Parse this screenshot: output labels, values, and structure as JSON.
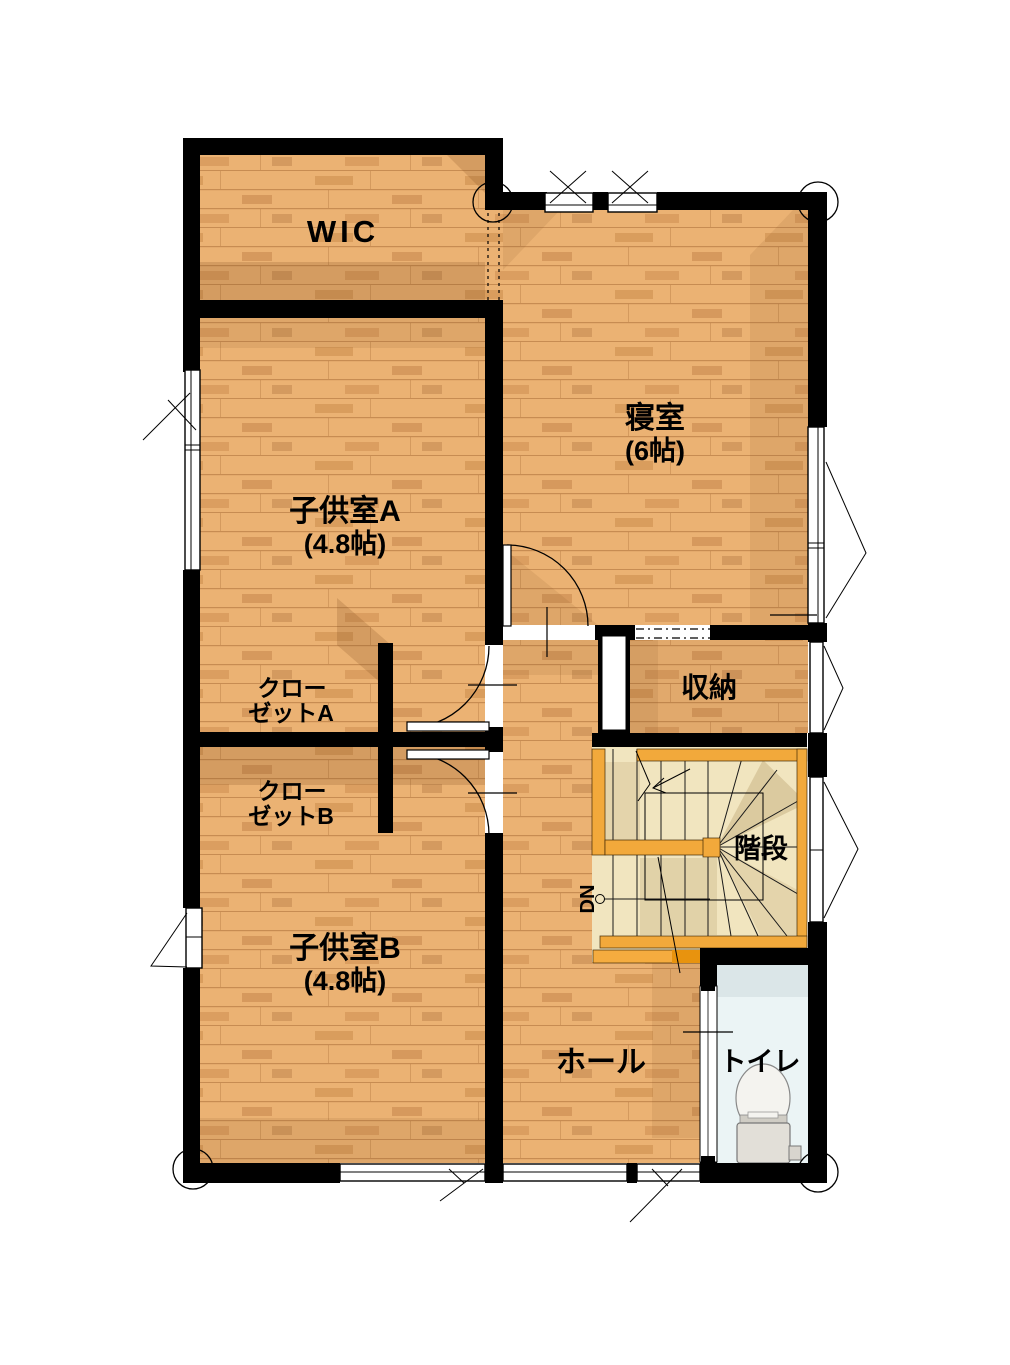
{
  "rooms": {
    "wic": {
      "label": "WIC"
    },
    "bedroom": {
      "label": "寝室",
      "size": "(6帖)"
    },
    "child_a": {
      "label": "子供室A",
      "size": "(4.8帖)"
    },
    "child_b": {
      "label": "子供室B",
      "size": "(4.8帖)"
    },
    "closet_a": {
      "line1": "クロー",
      "line2": "ゼットA"
    },
    "closet_b": {
      "line1": "クロー",
      "line2": "ゼットB"
    },
    "storage": {
      "label": "収納"
    },
    "stairs": {
      "label": "階段",
      "direction_label": "DN"
    },
    "hall": {
      "label": "ホール"
    },
    "toilet": {
      "label": "トイレ"
    }
  },
  "colors": {
    "wall": "#000000",
    "floor_wood": "#EBB273",
    "floor_wood_line": "#AA6E37",
    "stair_tread": "#F1E5BF",
    "stair_rail": "#F2A93B",
    "stair_landing": "#F5AC3F",
    "toilet_floor": "#EBF4F5",
    "background": "#FFFFFF"
  }
}
